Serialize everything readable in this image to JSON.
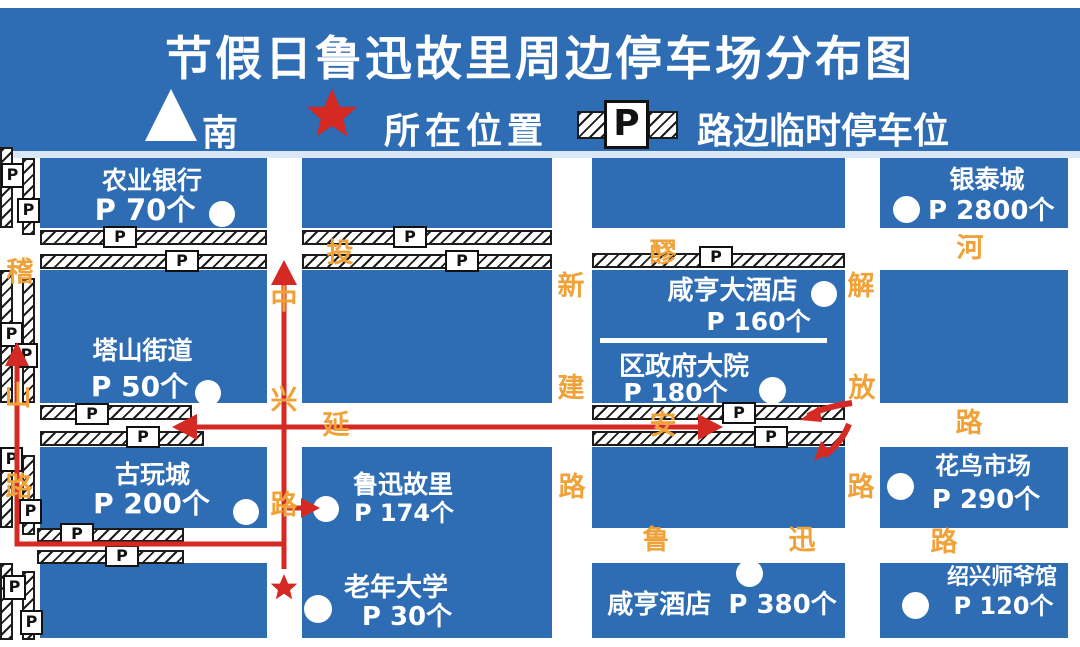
{
  "title": "节假日鲁迅故里周边停车场分布图",
  "legend": {
    "south_label": "南",
    "location_label": "所在位置",
    "roadside_parking_label": "路边临时停车位"
  },
  "p_marker": "P",
  "colors": {
    "map_blue": "#2e6cb4",
    "road_white": "#ffffff",
    "street_orange": "#f0a238",
    "route_red": "#d42a23"
  },
  "roads": {
    "jishan": [
      "稽",
      "山",
      "路"
    ],
    "zhongxing": [
      "中",
      "兴",
      "路"
    ],
    "xinjian": [
      "新",
      "建",
      "路"
    ],
    "jiefang": [
      "解",
      "放",
      "路"
    ],
    "taolaohe": [
      "投",
      "醪",
      "河"
    ],
    "yanan": [
      "延",
      "安",
      "路"
    ],
    "luxun": [
      "鲁",
      "迅",
      "路"
    ]
  },
  "sites": {
    "nongye_bank": {
      "name": "农业银行",
      "capacity": "P 70个"
    },
    "yintai_city": {
      "name": "银泰城",
      "capacity": "P 2800个"
    },
    "tashan_jiedao": {
      "name": "塔山街道",
      "capacity": "P 50个"
    },
    "xianheng_dajiudian": {
      "name": "咸亨大酒店",
      "capacity": "P 160个"
    },
    "district_gov": {
      "name": "区政府大院",
      "capacity": "P 180个"
    },
    "guwan_city": {
      "name": "古玩城",
      "capacity": "P 200个"
    },
    "luxun_guli": {
      "name": "鲁迅故里",
      "capacity": "P 174个"
    },
    "huaniao_market": {
      "name": "花鸟市场",
      "capacity": "P 290个"
    },
    "laonian_daxue": {
      "name": "老年大学",
      "capacity": "P 30个"
    },
    "xianheng_jiudian": {
      "name": "咸亨酒店",
      "capacity": "P 380个"
    },
    "shiye_museum": {
      "name": "绍兴师爷馆",
      "capacity": "P 120个"
    }
  }
}
